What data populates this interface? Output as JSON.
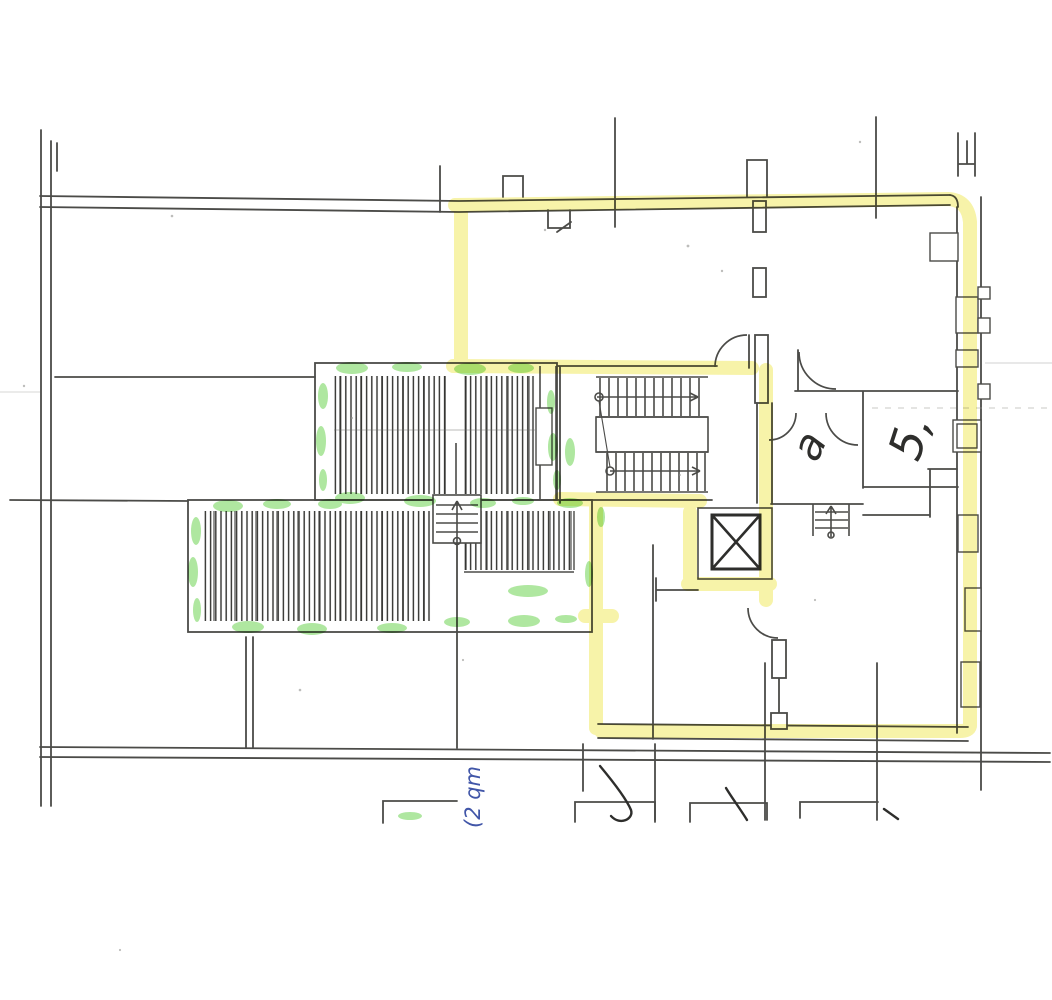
{
  "document": {
    "kind": "Scanned architectural floor plan with highlighter markup",
    "paper_color": "#ffffff"
  },
  "handwritten": {
    "room_label_a": "a",
    "room_label_5": "5,",
    "blue_note": "(2 qm"
  },
  "markers": {
    "yellow_highlighter": "#f6f2a0",
    "green_highlighter": "#7ed866",
    "pencil": "#4b4b48",
    "dark_ink": "#2e2e2c",
    "faint_pencil": "#9a9a96",
    "blue_ink": "#4156a8"
  }
}
